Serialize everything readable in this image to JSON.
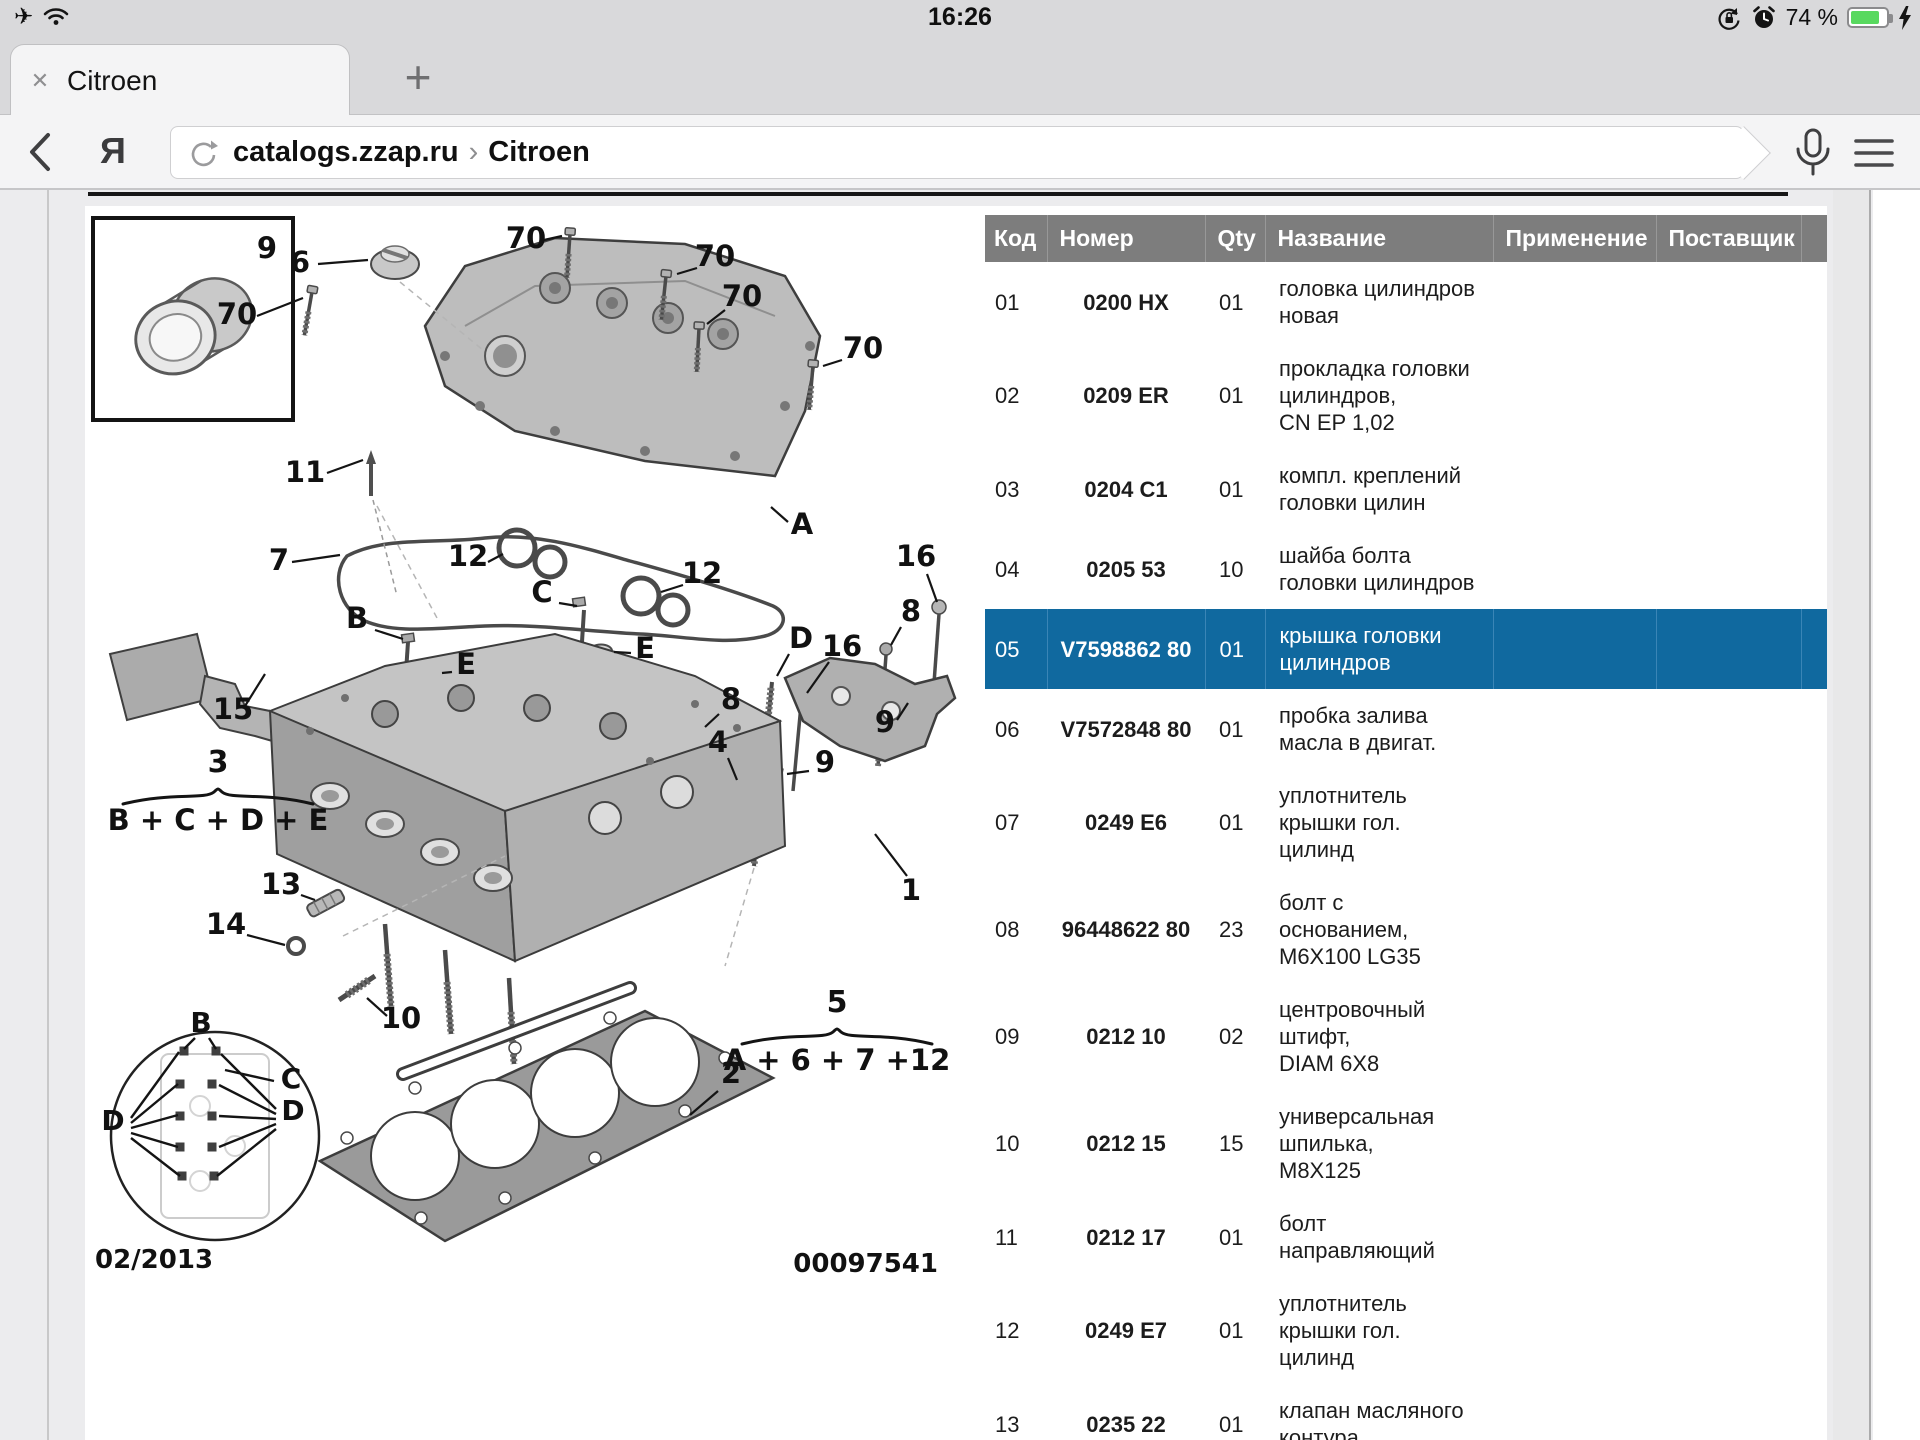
{
  "status_bar": {
    "time": "16:26",
    "battery_percent": "74 %"
  },
  "tab_bar": {
    "tab_title": "Citroen",
    "new_tab_label": "+"
  },
  "icons": {
    "close_tab": "✕",
    "airplane": "✈",
    "back_chevron": "‹",
    "yandex_logo": "Я"
  },
  "address_bar": {
    "url_host": "catalogs.zzap.ru",
    "url_sep": "›",
    "url_page": "Citroen"
  },
  "colors": {
    "highlight_row": "#10699f",
    "header_bg": "#7d7d7d",
    "battery_green": "#58d95f"
  },
  "table": {
    "headers": [
      "Код",
      "Номер",
      "Qty",
      "Название",
      "Применение",
      "Поставщик"
    ],
    "rows": [
      {
        "code": "01",
        "number": "0200 HX",
        "qty": "01",
        "name": "головка цилиндров\nновая",
        "application": "",
        "supplier": "",
        "highlight": false
      },
      {
        "code": "02",
        "number": "0209 ER",
        "qty": "01",
        "name": "прокладка головки\nцилиндров,\nCN EP 1,02",
        "application": "",
        "supplier": "",
        "highlight": false
      },
      {
        "code": "03",
        "number": "0204 C1",
        "qty": "01",
        "name": "компл. креплений\nголовки цилин",
        "application": "",
        "supplier": "",
        "highlight": false
      },
      {
        "code": "04",
        "number": "0205 53",
        "qty": "10",
        "name": "шайба болта\nголовки цилиндров",
        "application": "",
        "supplier": "",
        "highlight": false
      },
      {
        "code": "05",
        "number": "V7598862 80",
        "qty": "01",
        "name": "крышка головки\nцилиндров",
        "application": "",
        "supplier": "",
        "highlight": true
      },
      {
        "code": "06",
        "number": "V7572848 80",
        "qty": "01",
        "name": "пробка залива\nмасла в двигат.",
        "application": "",
        "supplier": "",
        "highlight": false
      },
      {
        "code": "07",
        "number": "0249 E6",
        "qty": "01",
        "name": "уплотнитель\nкрышки гол.\nцилинд",
        "application": "",
        "supplier": "",
        "highlight": false
      },
      {
        "code": "08",
        "number": "96448622 80",
        "qty": "23",
        "name": "болт с\nоснованием,\nM6X100 LG35",
        "application": "",
        "supplier": "",
        "highlight": false
      },
      {
        "code": "09",
        "number": "0212 10",
        "qty": "02",
        "name": "центровочный\nштифт,\nDIAM 6X8",
        "application": "",
        "supplier": "",
        "highlight": false
      },
      {
        "code": "10",
        "number": "0212 15",
        "qty": "15",
        "name": "универсальная\nшпилька,\nM8X125",
        "application": "",
        "supplier": "",
        "highlight": false
      },
      {
        "code": "11",
        "number": "0212 17",
        "qty": "01",
        "name": "болт\nнаправляющий",
        "application": "",
        "supplier": "",
        "highlight": false
      },
      {
        "code": "12",
        "number": "0249 E7",
        "qty": "01",
        "name": "уплотнитель\nкрышки гол.\nцилинд",
        "application": "",
        "supplier": "",
        "highlight": false
      },
      {
        "code": "13",
        "number": "0235 22",
        "qty": "01",
        "name": "клапан масляного\nконтура",
        "application": "",
        "supplier": "",
        "highlight": false
      }
    ]
  },
  "diagram": {
    "inset_label": "9",
    "footer_left": "02/2013",
    "footer_right": "00097541",
    "callouts": [
      {
        "t": "9",
        "x": 182,
        "y": 52
      },
      {
        "t": "6",
        "x": 215,
        "y": 66,
        "l": [
          233,
          58,
          283,
          54
        ]
      },
      {
        "t": "70",
        "x": 441,
        "y": 42,
        "l": [
          459,
          34,
          477,
          30
        ]
      },
      {
        "t": "70",
        "x": 630,
        "y": 60,
        "l": [
          612,
          62,
          592,
          68
        ]
      },
      {
        "t": "70",
        "x": 657,
        "y": 100,
        "l": [
          640,
          104,
          622,
          118
        ]
      },
      {
        "t": "70",
        "x": 152,
        "y": 118,
        "l": [
          172,
          110,
          218,
          92
        ]
      },
      {
        "t": "70",
        "x": 778,
        "y": 152,
        "l": [
          757,
          154,
          738,
          160
        ]
      },
      {
        "t": "11",
        "x": 220,
        "y": 276,
        "l": [
          242,
          267,
          278,
          254
        ]
      },
      {
        "t": "7",
        "x": 194,
        "y": 364,
        "l": [
          207,
          356,
          255,
          349
        ]
      },
      {
        "t": "12",
        "x": 383,
        "y": 360,
        "l": [
          403,
          356,
          418,
          348
        ]
      },
      {
        "t": "12",
        "x": 617,
        "y": 377,
        "l": [
          598,
          379,
          576,
          386
        ]
      },
      {
        "t": "B",
        "x": 272,
        "y": 422,
        "l": [
          290,
          424,
          318,
          433
        ]
      },
      {
        "t": "C",
        "x": 457,
        "y": 396,
        "l": [
          474,
          397,
          492,
          400
        ]
      },
      {
        "t": "E",
        "x": 560,
        "y": 452,
        "l": [
          546,
          447,
          529,
          446
        ]
      },
      {
        "t": "E",
        "x": 381,
        "y": 468,
        "l": [
          367,
          466,
          357,
          467
        ]
      },
      {
        "t": "D",
        "x": 716,
        "y": 442,
        "l": [
          704,
          448,
          692,
          470
        ]
      },
      {
        "t": "16",
        "x": 831,
        "y": 360,
        "l": [
          842,
          368,
          852,
          396
        ]
      },
      {
        "t": "8",
        "x": 826,
        "y": 415,
        "l": [
          816,
          421,
          806,
          439
        ]
      },
      {
        "t": "16",
        "x": 757,
        "y": 450,
        "l": [
          744,
          456,
          722,
          487
        ]
      },
      {
        "t": "8",
        "x": 646,
        "y": 503,
        "l": [
          634,
          508,
          620,
          521
        ]
      },
      {
        "t": "4",
        "x": 633,
        "y": 546,
        "l": [
          643,
          552,
          652,
          574
        ]
      },
      {
        "t": "9",
        "x": 800,
        "y": 526,
        "l": [
          812,
          514,
          823,
          497
        ]
      },
      {
        "t": "9",
        "x": 740,
        "y": 566,
        "l": [
          724,
          565,
          702,
          568
        ]
      },
      {
        "t": "15",
        "x": 148,
        "y": 513,
        "l": [
          160,
          500,
          180,
          468
        ]
      },
      {
        "t": "13",
        "x": 196,
        "y": 688,
        "l": [
          216,
          689,
          230,
          694
        ]
      },
      {
        "t": "14",
        "x": 141,
        "y": 728,
        "l": [
          162,
          729,
          200,
          739
        ]
      },
      {
        "t": "10",
        "x": 316,
        "y": 822,
        "l": [
          302,
          810,
          282,
          792
        ]
      },
      {
        "t": "1",
        "x": 826,
        "y": 694,
        "l": [
          822,
          670,
          790,
          628
        ]
      },
      {
        "t": "2",
        "x": 646,
        "y": 877,
        "l": [
          633,
          885,
          605,
          909
        ]
      },
      {
        "t": "A",
        "x": 717,
        "y": 328,
        "l": [
          703,
          316,
          686,
          301
        ]
      }
    ],
    "formulas": [
      {
        "top": "3",
        "bottom": "B + C + D + E",
        "x": 133,
        "top_y": 566,
        "brace_y": 582,
        "bottom_y": 624,
        "w": 95
      },
      {
        "top": "5",
        "bottom": "A + 6 + 7 +12",
        "x": 752,
        "top_y": 806,
        "brace_y": 822,
        "bottom_y": 864,
        "w": 95
      }
    ],
    "footer_texts": [
      {
        "t": "02/2013",
        "x": 10,
        "y": 1062,
        "anchor": "start"
      },
      {
        "t": "00097541",
        "x": 853,
        "y": 1066,
        "anchor": "end"
      }
    ],
    "detail_circle": {
      "cx": 130,
      "cy": 930,
      "r": 104,
      "labels": [
        {
          "t": "B",
          "x": 116,
          "y": 826,
          "lines": [
            [
              110,
              832,
              99,
              843
            ],
            [
              124,
              832,
              131,
              843
            ]
          ]
        },
        {
          "t": "C",
          "x": 206,
          "y": 882,
          "lines": [
            [
              189,
              875,
              140,
              864
            ]
          ]
        },
        {
          "t": "D",
          "x": 28,
          "y": 924,
          "lines": [
            [
              46,
              912,
              94,
              846
            ],
            [
              46,
              917,
              93,
              878
            ],
            [
              46,
              922,
              93,
              909
            ],
            [
              46,
              927,
              93,
              941
            ],
            [
              46,
              932,
              95,
              970
            ]
          ]
        },
        {
          "t": "D",
          "x": 208,
          "y": 914,
          "lines": [
            [
              191,
              903,
              136,
              848
            ],
            [
              191,
              908,
              134,
              879
            ],
            [
              191,
              913,
              134,
              910
            ],
            [
              191,
              918,
              134,
              941
            ],
            [
              191,
              923,
              132,
              970
            ]
          ]
        }
      ],
      "bolts": [
        [
          99,
          845
        ],
        [
          131,
          845
        ],
        [
          95,
          878
        ],
        [
          127,
          878
        ],
        [
          95,
          910
        ],
        [
          127,
          910
        ],
        [
          95,
          941
        ],
        [
          127,
          941
        ],
        [
          97,
          970
        ],
        [
          129,
          970
        ]
      ]
    }
  }
}
